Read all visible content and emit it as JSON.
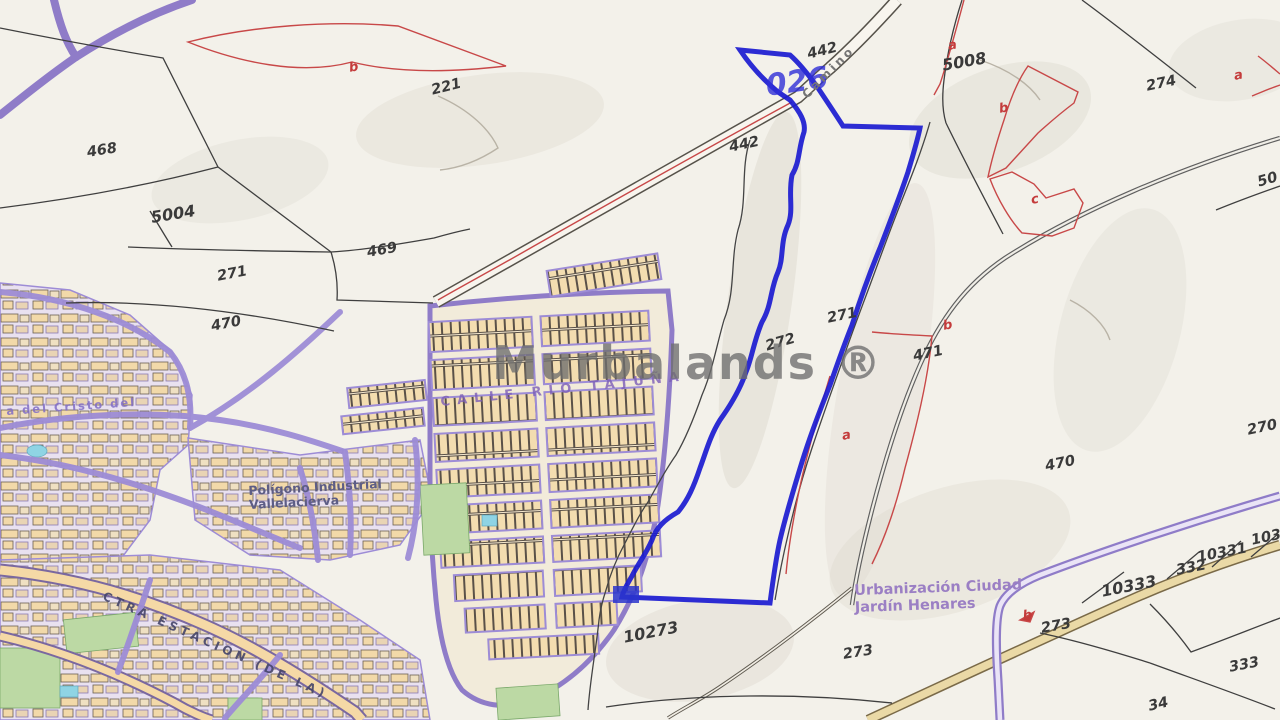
{
  "watermark": "Murbalands ®",
  "labels": {
    "p468": "468",
    "p5004": "5004",
    "p271a": "271",
    "p470a": "470",
    "sub_b1": "b",
    "p221": "221",
    "p469": "469",
    "p442a": "442",
    "p442b": "442",
    "road026": "026",
    "sub_a1": "a",
    "p5008": "5008",
    "sub_b2": "b",
    "sub_c1": "c",
    "p274": "274",
    "sub_a2": "a",
    "p50": "50",
    "p272": "272",
    "p271b": "271",
    "sub_b3": "b",
    "p471": "471",
    "sub_a3": "a",
    "p470b": "470",
    "p270": "270",
    "p1033": "1033",
    "p10331": "10331",
    "p332": "332",
    "p10333": "10333",
    "sub_b4": "b",
    "p273a": "273",
    "p333a": "333",
    "p34": "34",
    "p273b": "273",
    "p10273": "10273"
  },
  "streets": {
    "camino_top": "Camino",
    "calle_rio_tajuna": "CALLE RIO TAJUÑA",
    "ctra_estacion": "CTRA ESTACION (DE LA)",
    "cristo_del": "a del Cristo del",
    "poligono_1": "Polígono Industrial",
    "poligono_2": "Vallelacierva",
    "urbanizacion_1": "Urbanización Ciudad",
    "urbanizacion_2": "Jardín Henares"
  },
  "colors": {
    "boundary_blue": "#1b1bd0",
    "subparcel_red": "#c84848",
    "road_purple": "#9d8cd6",
    "building_tan": "#f2d9a9",
    "green_area": "#bcd9a4",
    "water_cyan": "#8fd4e4",
    "watermark_gray": "#6e6e6e"
  }
}
